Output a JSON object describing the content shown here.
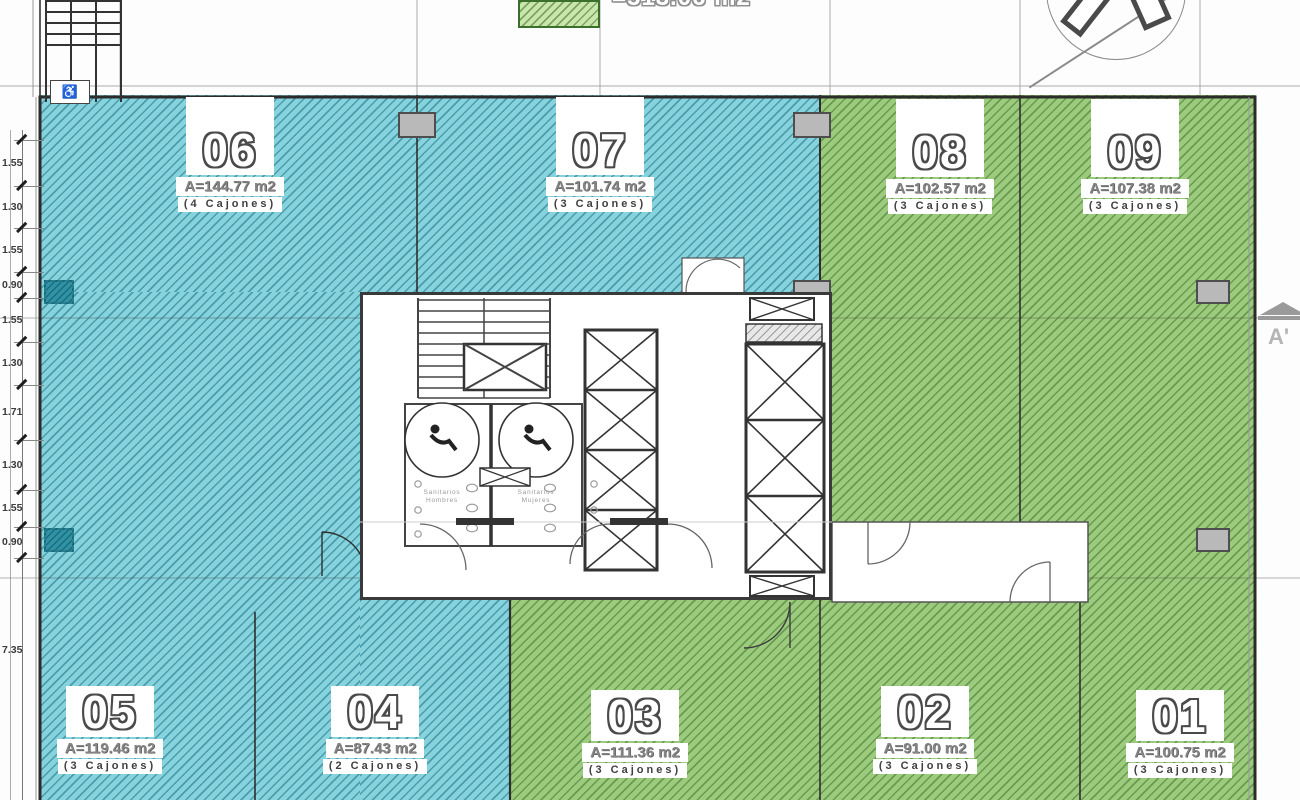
{
  "legend": {
    "label": "=513.06 m2",
    "swatch_color": "#c9e7aa"
  },
  "units": [
    {
      "id": "06",
      "area": "A=144.77 m2",
      "parking": "(4 Cajones)",
      "zone": "blue"
    },
    {
      "id": "07",
      "area": "A=101.74 m2",
      "parking": "(3 Cajones)",
      "zone": "blue"
    },
    {
      "id": "08",
      "area": "A=102.57 m2",
      "parking": "(3 Cajones)",
      "zone": "green"
    },
    {
      "id": "09",
      "area": "A=107.38 m2",
      "parking": "(3 Cajones)",
      "zone": "green"
    },
    {
      "id": "05",
      "area": "A=119.46 m2",
      "parking": "(3 Cajones)",
      "zone": "blue"
    },
    {
      "id": "04",
      "area": "A=87.43 m2",
      "parking": "(2 Cajones)",
      "zone": "blue"
    },
    {
      "id": "03",
      "area": "A=111.36 m2",
      "parking": "(3 Cajones)",
      "zone": "green"
    },
    {
      "id": "02",
      "area": "A=91.00 m2",
      "parking": "(3 Cajones)",
      "zone": "green"
    },
    {
      "id": "01",
      "area": "A=100.75 m2",
      "parking": "(3 Cajones)",
      "zone": "green"
    }
  ],
  "dimensions": [
    "1.55",
    "1.30",
    "1.55",
    "0.90",
    "1.55",
    "1.30",
    "1.71",
    "1.30",
    "1.55",
    "0.90",
    "7.35"
  ],
  "core": {
    "bathroom_left": {
      "l1": "Sanitarios",
      "l2": "Hombres"
    },
    "bathroom_right": {
      "l1": "Sanitarios",
      "l2": "Mujeres"
    }
  },
  "section_marker": "A'",
  "colors": {
    "zone_blue": "#87d3dd",
    "zone_blue_hatch": "#177083",
    "zone_green": "#9ccb7d",
    "zone_green_hatch": "#346923",
    "walls": "#2b2b2b",
    "columns": "#b9b9b9"
  }
}
